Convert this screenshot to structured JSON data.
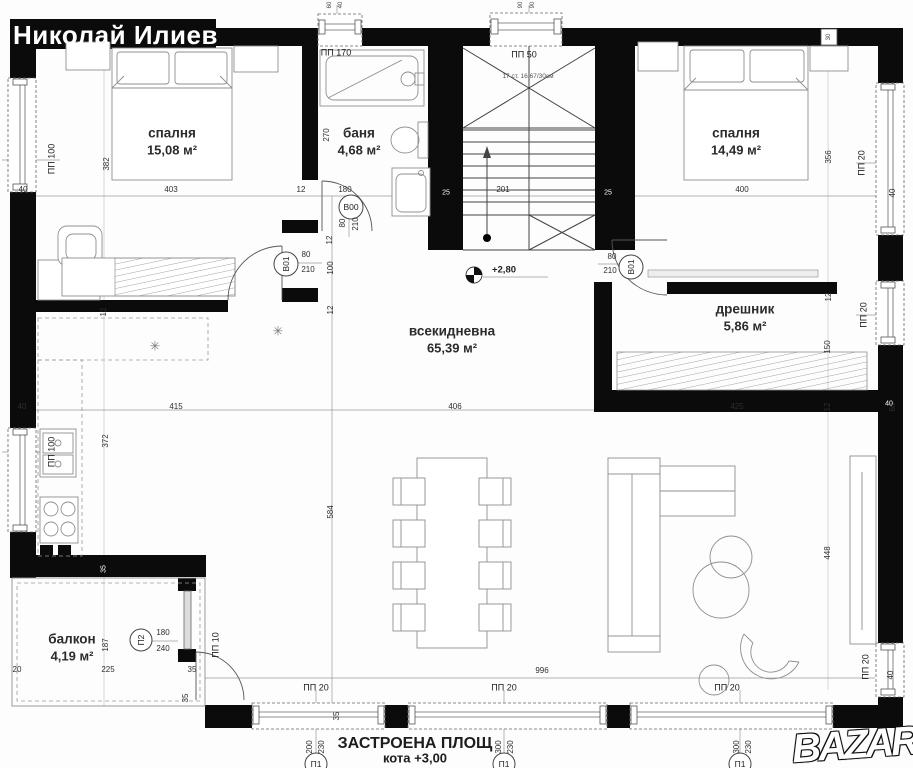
{
  "watermark": {
    "name": "Николай Илиев"
  },
  "logo": {
    "text": "BAZAR"
  },
  "summary": {
    "line1": "ЗАСТРОЕНА ПЛОЩ",
    "line2": "кота +3,00",
    "line3": "137,00 м²"
  },
  "colors": {
    "wall": "#0b0b0b",
    "line": "#8f8f8f",
    "text": "#2e2e2e",
    "background": "#fdfdfd"
  },
  "rooms": [
    {
      "name": "спалня",
      "area": "15,08 м²",
      "x": 172,
      "y": 133
    },
    {
      "name": "баня",
      "area": "4,68 м²",
      "x": 359,
      "y": 133
    },
    {
      "name": "спалня",
      "area": "14,49 м²",
      "x": 736,
      "y": 133
    },
    {
      "name": "всекидневна",
      "area": "65,39 м²",
      "x": 452,
      "y": 331
    },
    {
      "name": "дрешник",
      "area": "5,86 м²",
      "x": 745,
      "y": 309
    },
    {
      "name": "балкон",
      "area": "4,19 м²",
      "x": 72,
      "y": 639
    }
  ],
  "plan": {
    "stairs_note": "17 ст. 16,67/30см",
    "level_mark": "+2,80",
    "labels": [
      {
        "t": "40",
        "x": 23,
        "y": 190
      },
      {
        "t": "403",
        "x": 171,
        "y": 190
      },
      {
        "t": "12",
        "x": 301,
        "y": 190
      },
      {
        "t": "180",
        "x": 345,
        "y": 190
      },
      {
        "t": "201",
        "x": 503,
        "y": 190
      },
      {
        "t": "400",
        "x": 742,
        "y": 190
      },
      {
        "t": "40",
        "x": 893,
        "y": 193,
        "r": 1
      },
      {
        "t": "382",
        "x": 107,
        "y": 164,
        "r": 1
      },
      {
        "t": "356",
        "x": 829,
        "y": 157,
        "r": 1
      },
      {
        "t": "270",
        "x": 327,
        "y": 135,
        "r": 1
      },
      {
        "t": "12",
        "x": 330,
        "y": 240,
        "r": 1
      },
      {
        "t": "100",
        "x": 331,
        "y": 268,
        "r": 1
      },
      {
        "t": "12",
        "x": 331,
        "y": 310,
        "r": 1
      },
      {
        "t": "12",
        "x": 104,
        "y": 312,
        "r": 1
      },
      {
        "t": "40",
        "x": 22,
        "y": 407
      },
      {
        "t": "415",
        "x": 176,
        "y": 407
      },
      {
        "t": "406",
        "x": 455,
        "y": 407
      },
      {
        "t": "425",
        "x": 737,
        "y": 407
      },
      {
        "t": "12",
        "x": 828,
        "y": 407,
        "r": 1
      },
      {
        "t": "60",
        "x": 893,
        "y": 407,
        "r": 1
      },
      {
        "t": "372",
        "x": 106,
        "y": 441,
        "r": 1
      },
      {
        "t": "584",
        "x": 331,
        "y": 512,
        "r": 1
      },
      {
        "t": "448",
        "x": 828,
        "y": 553,
        "r": 1
      },
      {
        "t": "12",
        "x": 829,
        "y": 297,
        "r": 1
      },
      {
        "t": "150",
        "x": 828,
        "y": 347,
        "r": 1
      },
      {
        "t": "187",
        "x": 106,
        "y": 645,
        "r": 1
      },
      {
        "t": "225",
        "x": 108,
        "y": 670
      },
      {
        "t": "20",
        "x": 17,
        "y": 670
      },
      {
        "t": "35",
        "x": 192,
        "y": 670
      },
      {
        "t": "35",
        "x": 186,
        "y": 698,
        "r": 1
      },
      {
        "t": "996",
        "x": 542,
        "y": 671
      },
      {
        "t": "200",
        "x": 310,
        "y": 747,
        "r": 1
      },
      {
        "t": "230",
        "x": 322,
        "y": 747,
        "r": 1
      },
      {
        "t": "300",
        "x": 499,
        "y": 747,
        "r": 1
      },
      {
        "t": "230",
        "x": 511,
        "y": 747,
        "r": 1
      },
      {
        "t": "300",
        "x": 737,
        "y": 747,
        "r": 1
      },
      {
        "t": "230",
        "x": 749,
        "y": 747,
        "r": 1
      },
      {
        "t": "180",
        "x": 163,
        "y": 633
      },
      {
        "t": "240",
        "x": 163,
        "y": 649
      },
      {
        "t": "80",
        "x": 306,
        "y": 255
      },
      {
        "t": "210",
        "x": 308,
        "y": 270
      },
      {
        "t": "80",
        "x": 612,
        "y": 257
      },
      {
        "t": "210",
        "x": 610,
        "y": 271
      },
      {
        "t": "80",
        "x": 343,
        "y": 223,
        "r": 1
      },
      {
        "t": "210",
        "x": 356,
        "y": 224,
        "r": 1
      },
      {
        "t": "35",
        "x": 337,
        "y": 716,
        "r": 1
      },
      {
        "t": "60",
        "x": 330,
        "y": 5,
        "r": 1,
        "c": "t"
      },
      {
        "t": "40",
        "x": 341,
        "y": 5,
        "r": 1,
        "c": "t"
      },
      {
        "t": "90",
        "x": 521,
        "y": 5,
        "r": 1,
        "c": "t"
      },
      {
        "t": "90",
        "x": 533,
        "y": 5,
        "r": 1,
        "c": "t"
      },
      {
        "t": "25",
        "x": 446,
        "y": 193,
        "c": "w"
      },
      {
        "t": "25",
        "x": 608,
        "y": 193,
        "c": "w"
      },
      {
        "t": "35",
        "x": 104,
        "y": 569,
        "r": 1,
        "c": "w"
      },
      {
        "t": "40",
        "x": 889,
        "y": 404,
        "c": "w"
      },
      {
        "t": "30",
        "x": 829,
        "y": 37,
        "r": 1,
        "c": "t"
      },
      {
        "t": "ПП 170",
        "x": 336,
        "y": 53,
        "c": "pc"
      },
      {
        "t": "ПП 50",
        "x": 524,
        "y": 55,
        "c": "pc"
      },
      {
        "t": "ПП 100",
        "x": 52,
        "y": 159,
        "r": 1,
        "c": "pc"
      },
      {
        "t": "ПП 100",
        "x": 52,
        "y": 452,
        "r": 1,
        "c": "pc"
      },
      {
        "t": "ПП 20",
        "x": 862,
        "y": 163,
        "r": 1,
        "c": "pc"
      },
      {
        "t": "ПП 20",
        "x": 864,
        "y": 315,
        "r": 1,
        "c": "pc"
      },
      {
        "t": "ПП 20",
        "x": 866,
        "y": 667,
        "r": 1,
        "c": "pc"
      },
      {
        "t": "40",
        "x": 891,
        "y": 675,
        "r": 1
      },
      {
        "t": "ПП 10",
        "x": 216,
        "y": 645,
        "r": 1,
        "c": "pc"
      },
      {
        "t": "ПП 20",
        "x": 316,
        "y": 688,
        "c": "pc"
      },
      {
        "t": "ПП 20",
        "x": 504,
        "y": 688,
        "c": "pc"
      },
      {
        "t": "ПП 20",
        "x": 727,
        "y": 688,
        "c": "pc"
      },
      {
        "t": "B00",
        "x": 351,
        "y": 207,
        "c": "dc"
      },
      {
        "t": "B01",
        "x": 286,
        "y": 264,
        "r": 1,
        "c": "dc"
      },
      {
        "t": "B01",
        "x": 631,
        "y": 267,
        "r": 1,
        "c": "dc"
      },
      {
        "t": "П2",
        "x": 141,
        "y": 640,
        "r": 1,
        "c": "dc"
      },
      {
        "t": "П1",
        "x": 316,
        "y": 764,
        "c": "dc"
      },
      {
        "t": "П1",
        "x": 504,
        "y": 764,
        "c": "dc"
      },
      {
        "t": "П1",
        "x": 740,
        "y": 764,
        "c": "dc"
      },
      {
        "t": "17 ст. 16,67/30см",
        "x": 528,
        "y": 77,
        "c": "n"
      },
      {
        "t": "+2,80",
        "x": 504,
        "y": 270,
        "c": "lv"
      },
      {
        "t": "✳",
        "x": 278,
        "y": 331,
        "c": "st"
      },
      {
        "t": "✳",
        "x": 155,
        "y": 346,
        "c": "st"
      }
    ]
  }
}
